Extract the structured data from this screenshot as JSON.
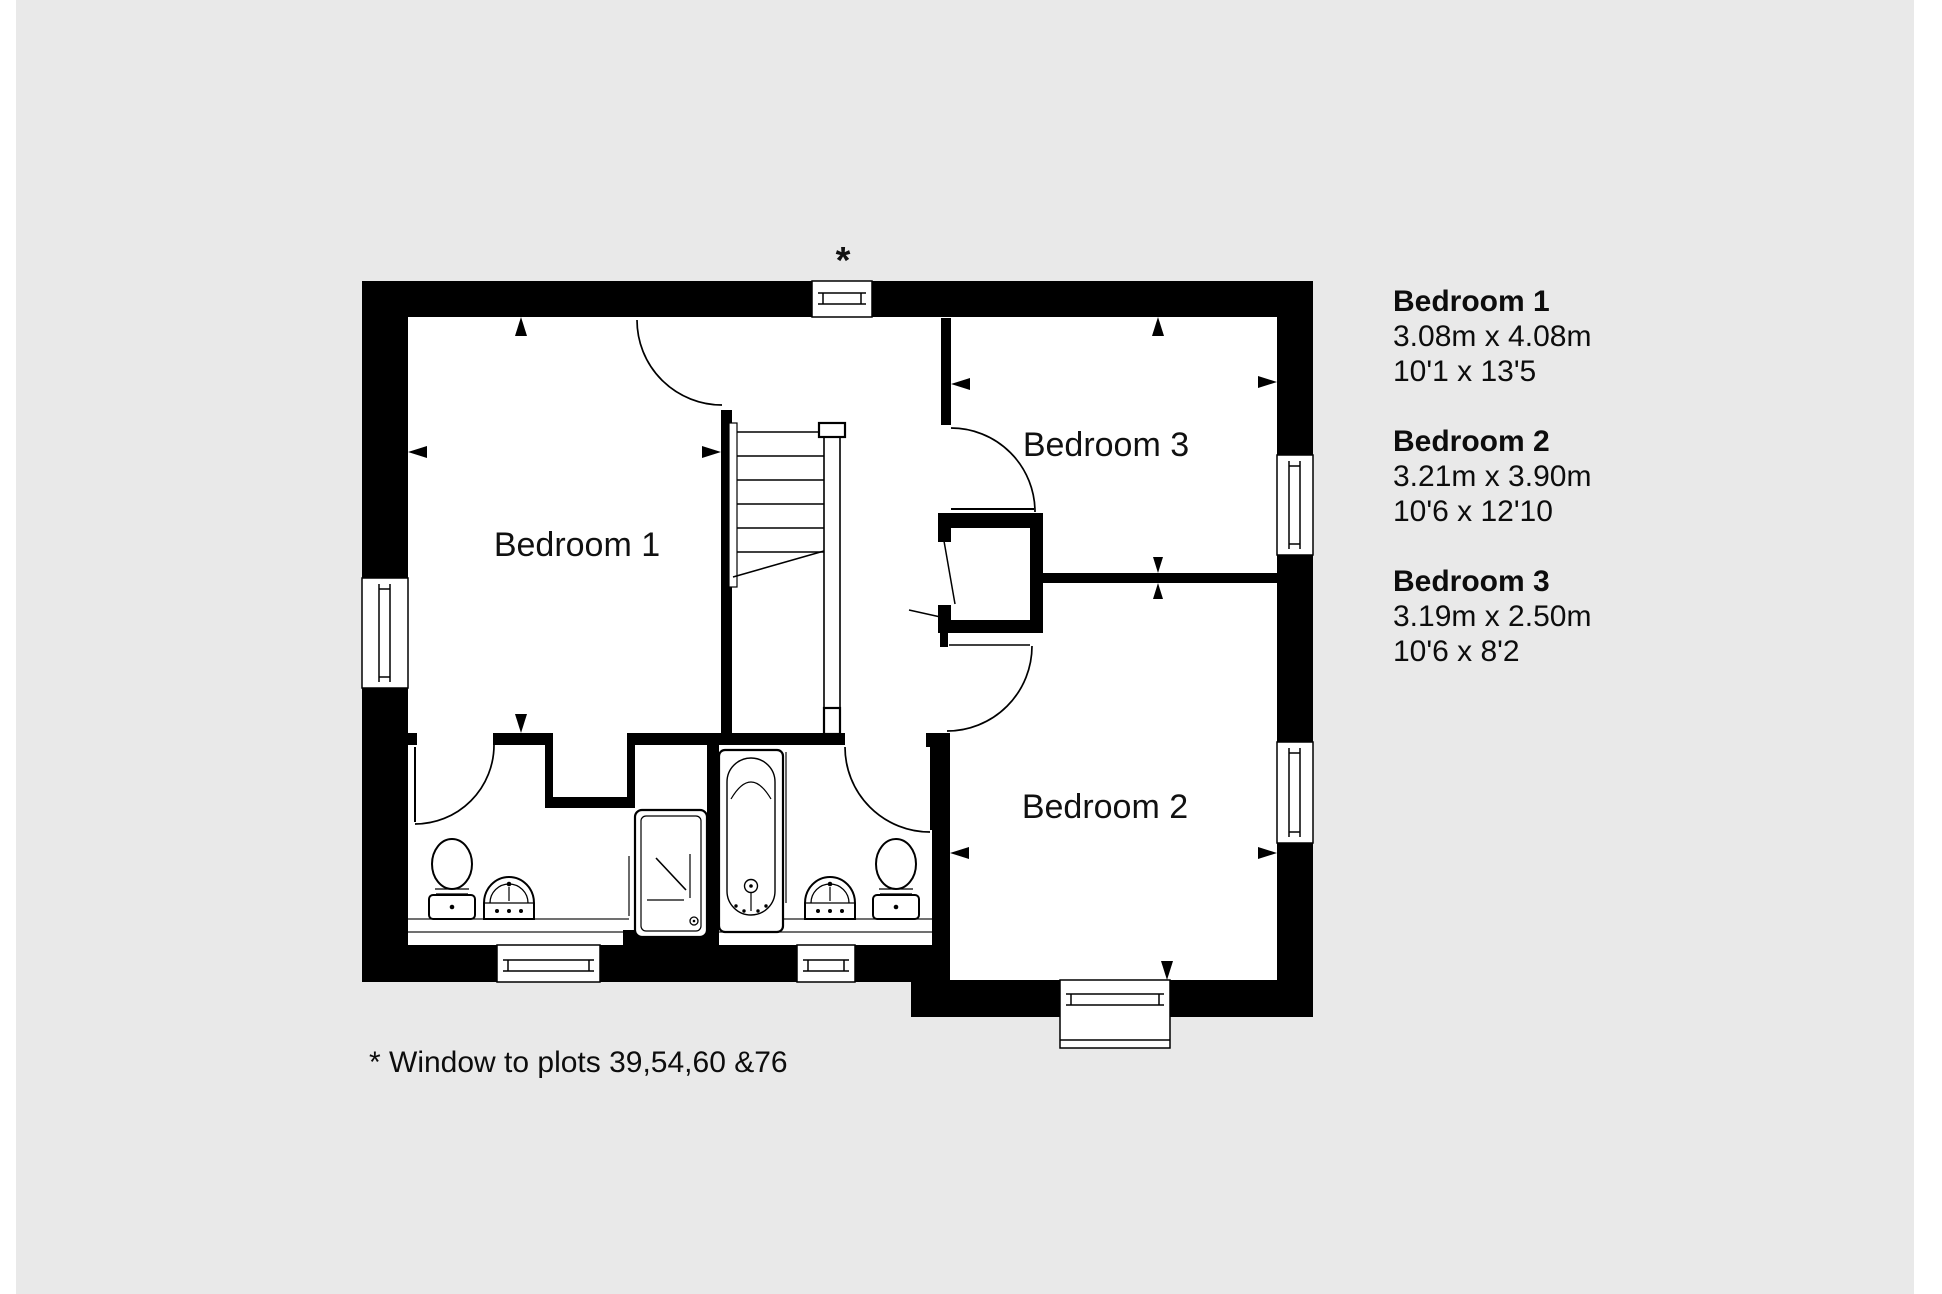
{
  "floor_plan": {
    "rooms": [
      {
        "id": "bedroom-1",
        "label": "Bedroom 1"
      },
      {
        "id": "bedroom-3",
        "label": "Bedroom 3"
      },
      {
        "id": "bedroom-2",
        "label": "Bedroom 2"
      }
    ],
    "window_marker": "*"
  },
  "legend": {
    "items": [
      {
        "name": "Bedroom 1",
        "metric": "3.08m x 4.08m",
        "imperial": "10'1 x 13'5"
      },
      {
        "name": "Bedroom 2",
        "metric": "3.21m x 3.90m",
        "imperial": "10'6 x 12'10"
      },
      {
        "name": "Bedroom 3",
        "metric": "3.19m x 2.50m",
        "imperial": "10'6 x 8'2"
      }
    ]
  },
  "footnote": "* Window to plots 39,54,60 &76",
  "colors": {
    "background": "#e9e9e9",
    "wall": "#000000",
    "floor": "#ffffff",
    "line": "#000000"
  }
}
